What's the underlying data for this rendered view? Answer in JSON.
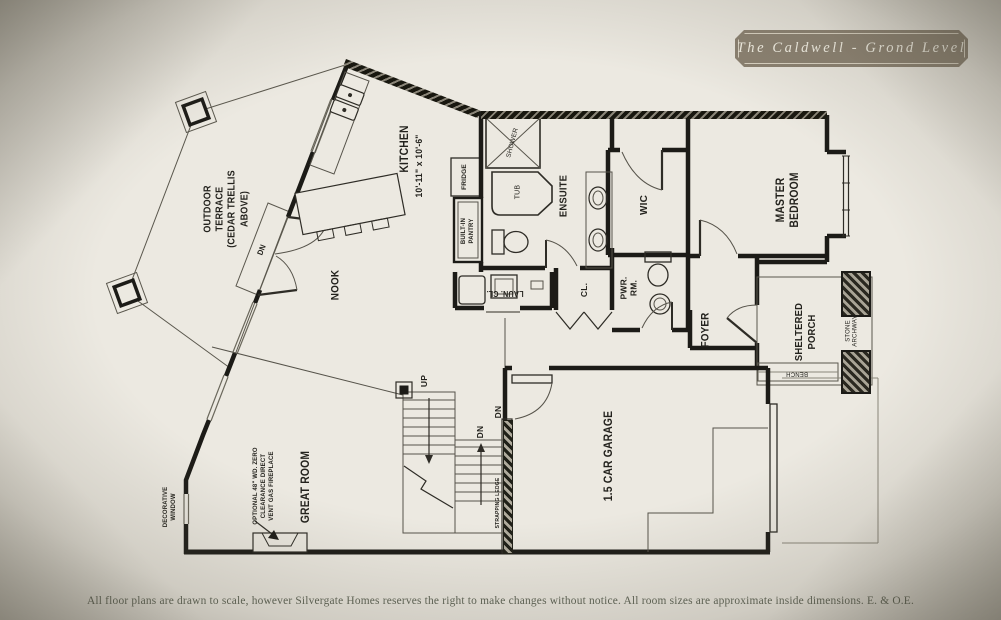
{
  "title_badge": {
    "text": "The Caldwell - Grond Level"
  },
  "footer": {
    "disclaimer": "All floor plans are drawn to scale, however Silvergate Homes reserves the right to make changes without notice. All room sizes are approximate inside dimensions. E. & O.E."
  },
  "colors": {
    "paper": "#ece9e1",
    "badge_bg": "#8b8171",
    "badge_text": "#f4f1e6",
    "wall": "#1c1b17",
    "label_text": "#23221d",
    "disclaimer_text": "#5c6254"
  },
  "plan": {
    "rooms": {
      "outdoor_terrace": "OUTDOOR\nTERRACE\n(CEDAR TRELLIS\nABOVE)",
      "kitchen": "KITCHEN",
      "kitchen_dims": "10'-11\" x 10'-6\"",
      "nook": "NOOK",
      "great_room": "GREAT ROOM",
      "garage": "1.5 CAR GARAGE",
      "master_bedroom": "MASTER\nBEDROOM",
      "ensuite": "ENSUITE",
      "wic": "WIC",
      "foyer": "FOYER",
      "sheltered_porch": "SHELTERED\nPORCH",
      "stone_archway": "STONE\nARCHWAY",
      "bench": "BENCH",
      "pwr_rm": "PWR.\nRM.",
      "closet": "CL.",
      "laundry_closet": "LAUN. CL.",
      "built_in_pantry": "BUILT-IN\nPANTRY",
      "fridge": "FRIDGE",
      "shower": "SHOWER",
      "tub": "TUB",
      "up": "UP",
      "dn_terrace": "DN",
      "dn_stairs": "DN",
      "dn_garage": "DN",
      "strapping_ledge": "STRAPPING LEDGE",
      "fireplace_note": "OPTIONAL 48\" WD. ZERO\nCLEARANCE DIRECT\nVENT GAS FIREPLACE",
      "decorative_window": "DECORATIVE\nWINDOW"
    }
  }
}
